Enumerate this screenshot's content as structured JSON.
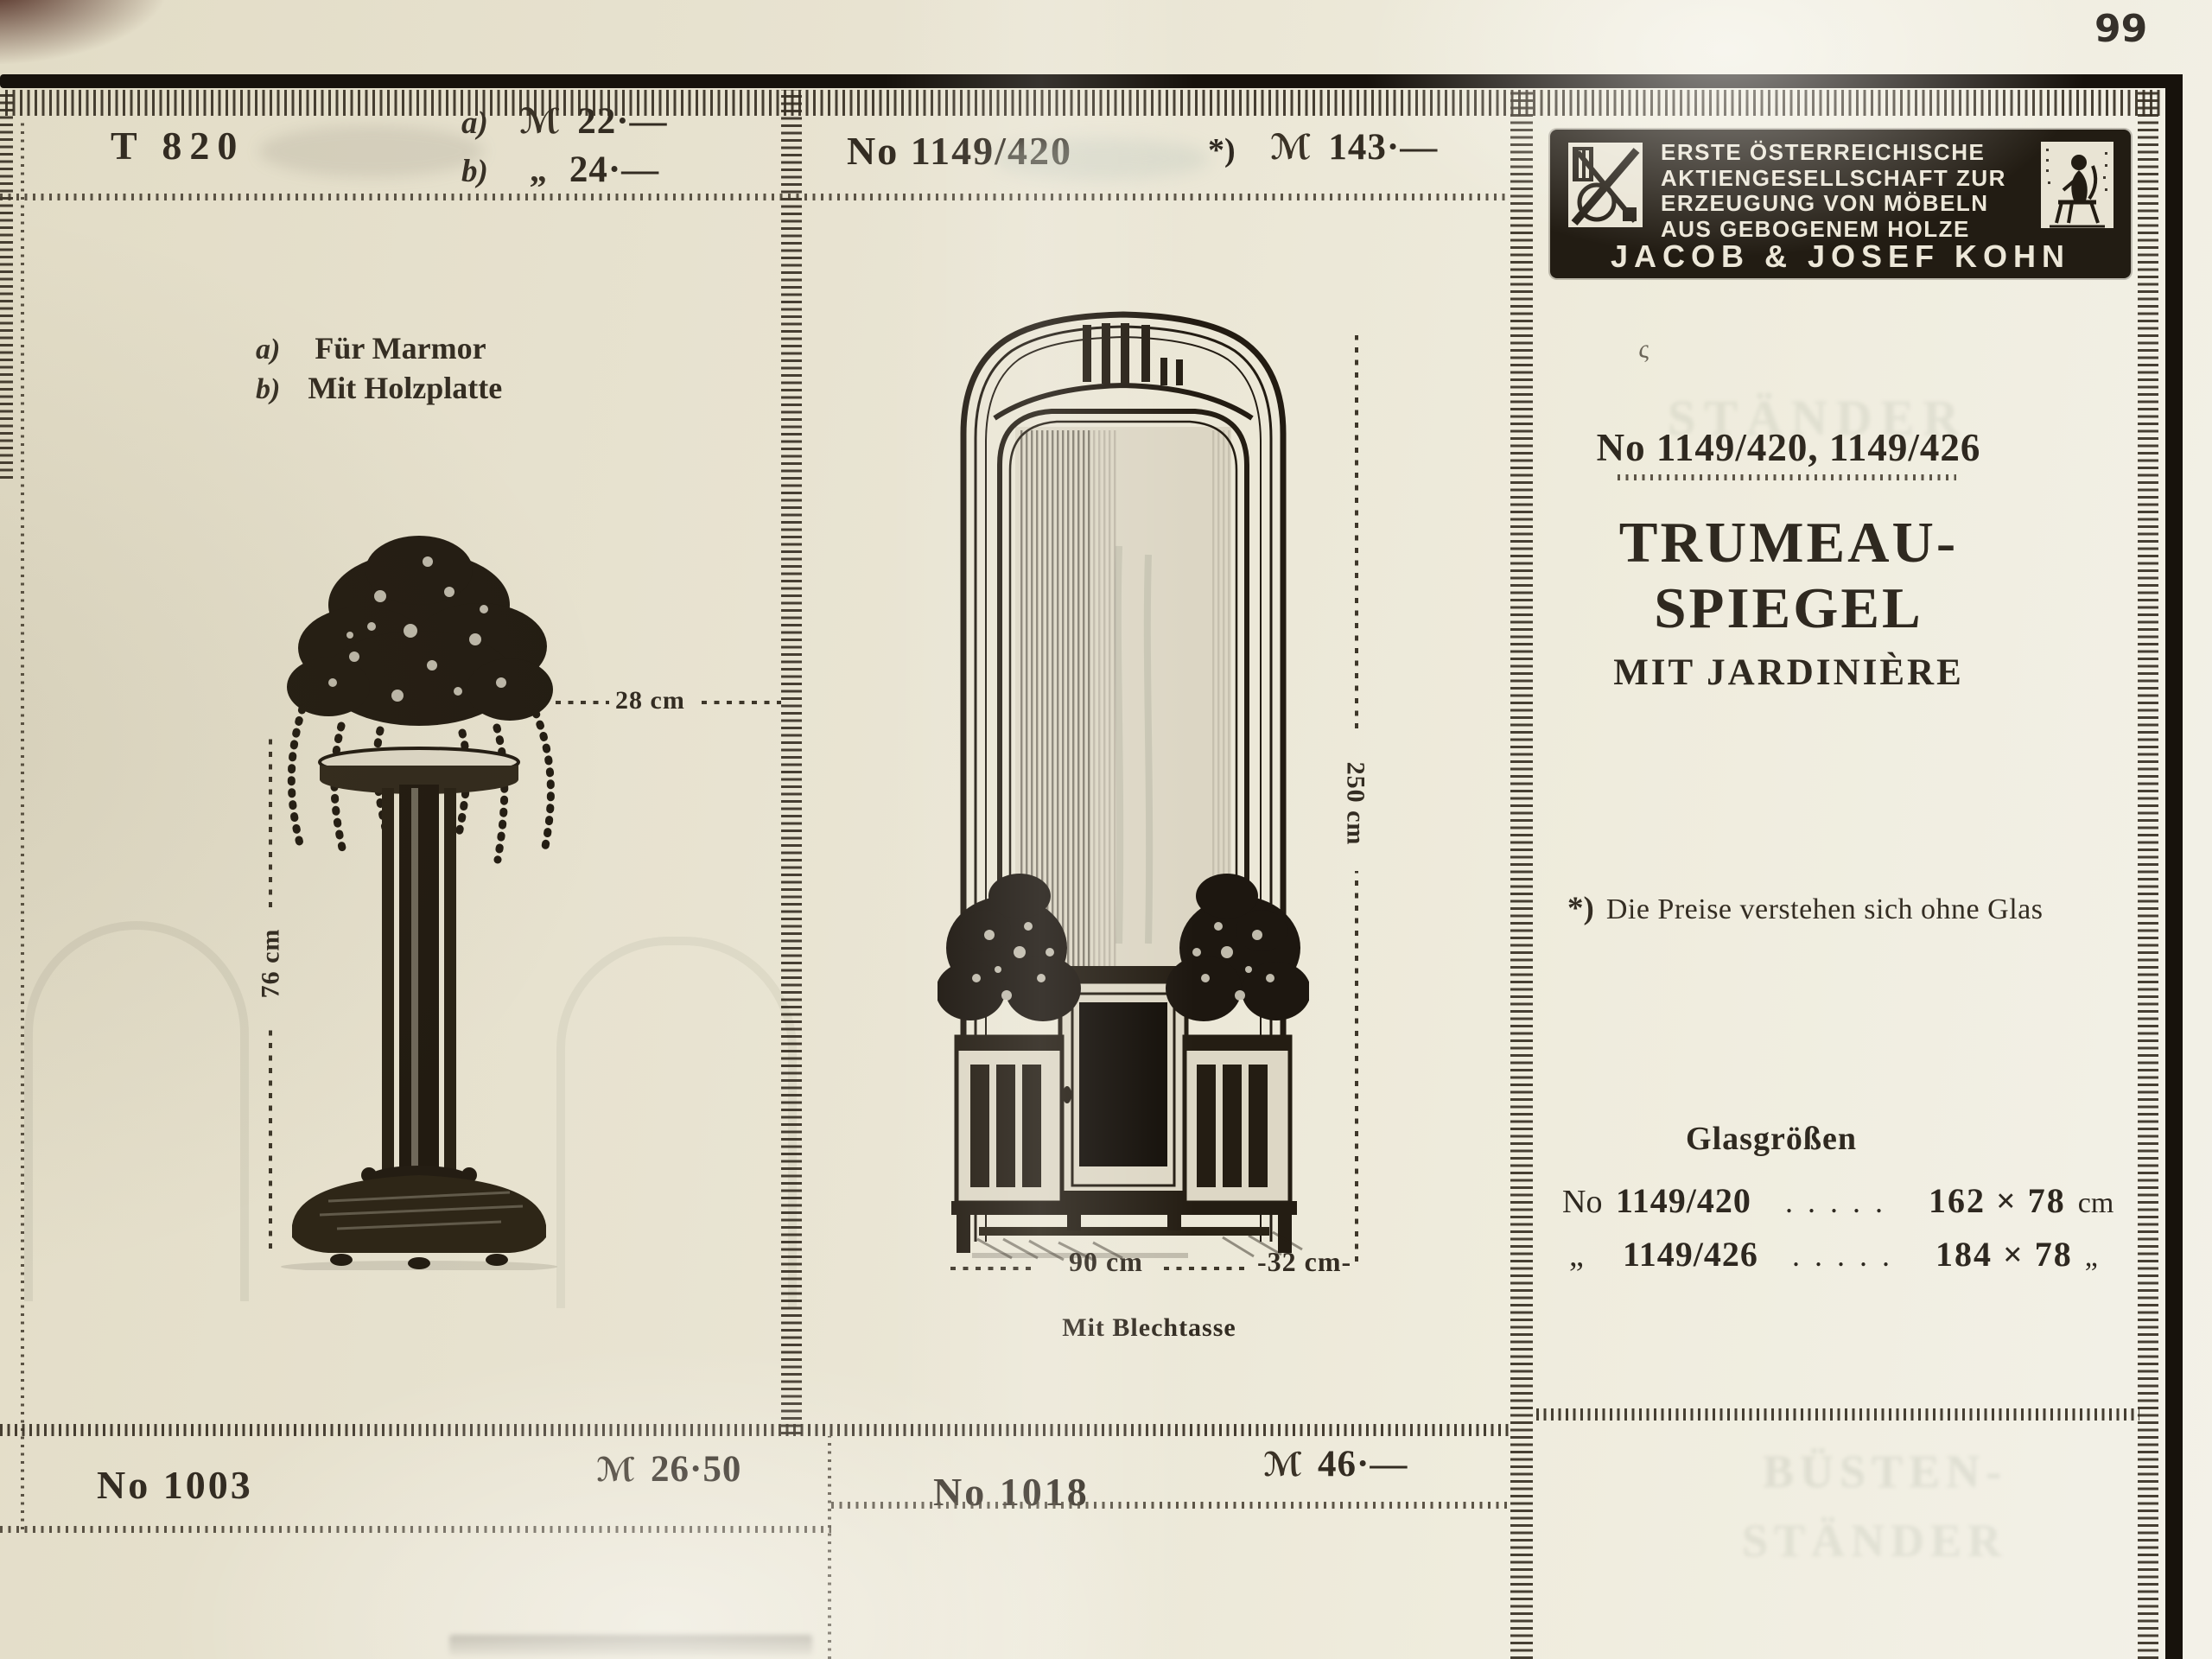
{
  "page": {
    "number": "99"
  },
  "colors": {
    "paper": "#e8e3d2",
    "ink": "#241d13",
    "logo_bg": "#221c13"
  },
  "icons": {
    "monogram": "kohn-monogram",
    "trademark": "seated-man-trademark"
  },
  "cells": {
    "left_top": {
      "model": "T 820",
      "variant_a": "a)",
      "currency": "ℳ",
      "price_a": "22·—",
      "variant_b": "b)",
      "ditto": "„",
      "price_b": "24·—"
    },
    "left": {
      "variant_a": "a)",
      "note_a": "Für Marmor",
      "variant_b": "b)",
      "note_b": "Mit Holzplatte",
      "dim_width": "28 cm",
      "dim_height": "76 cm"
    },
    "middle": {
      "model": "No 1149/420",
      "footnote_mark": "*)",
      "currency": "ℳ",
      "price": "143·—",
      "dim_height": "250 cm",
      "dim_width": "90 cm",
      "dim_depth": "-32 cm-",
      "caption": "Mit Blechtasse"
    },
    "bottom_left": {
      "model": "No 1003",
      "currency": "ℳ",
      "price": "26·50"
    },
    "bottom_middle": {
      "model": "No 1018",
      "currency": "ℳ",
      "price": "46·—"
    }
  },
  "right_panel": {
    "logo": {
      "line1": "ERSTE ÖSTERREICHISCHE",
      "line2": "AKTIENGESELLSCHAFT ZUR",
      "line3": "ERZEUGUNG VON MÖBELN",
      "line4": "AUS GEBOGENEM HOLZE",
      "company": "JACOB & JOSEF KOHN"
    },
    "handwritten_mark": "ς",
    "model_line": "No 1149/420, 1149/426",
    "title_line1": "TRUMEAU-",
    "title_line2": "SPIEGEL",
    "subtitle": "MIT JARDINIÈRE",
    "footnote_mark": "*)",
    "footnote": "Die Preise verstehen sich ohne Glas",
    "glass_header": "Glasgrößen",
    "glass_rows": [
      {
        "no_label": "No",
        "model": "1149/420",
        "leader": ". . . . .",
        "size": "162 × 78",
        "unit": "cm"
      },
      {
        "no_label": "„",
        "model": "1149/426",
        "leader": ". . . . .",
        "size": "184 × 78",
        "unit": "„"
      }
    ],
    "ghosts": {
      "mid": "STÄNDER",
      "bottom1": "BÜSTEN-",
      "bottom2": "STÄNDER"
    }
  }
}
